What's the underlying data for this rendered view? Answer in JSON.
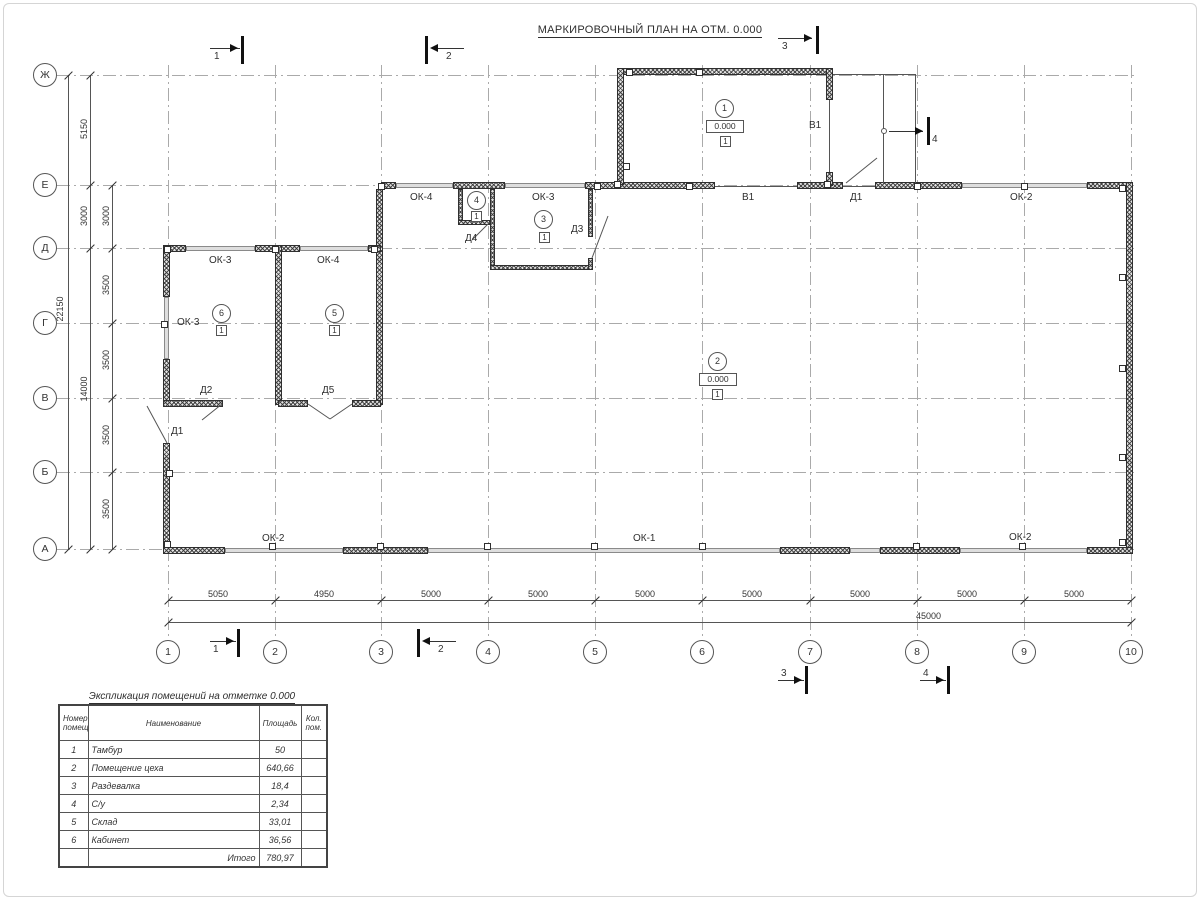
{
  "title": "МАРКИРОВОЧНЫЙ ПЛАН НА ОТМ. 0.000",
  "axis_rows": [
    "Ж",
    "Е",
    "Д",
    "Г",
    "В",
    "Б",
    "А"
  ],
  "axis_cols": [
    "1",
    "2",
    "3",
    "4",
    "5",
    "6",
    "7",
    "8",
    "9",
    "10"
  ],
  "dims": {
    "total_height": "22150",
    "total_width": "45000",
    "col_a": [
      "5150",
      "3000",
      "14000"
    ],
    "col_b": [
      "3000",
      "3500",
      "3500",
      "3500",
      "3500"
    ],
    "bottom": [
      "5050",
      "4950",
      "5000",
      "5000",
      "5000",
      "5000",
      "5000",
      "5000",
      "5000"
    ]
  },
  "sections": {
    "s1": "1",
    "s2": "2",
    "s3": "3",
    "s4": "4"
  },
  "labels": {
    "ok1": "ОК-1",
    "ok2": "ОК-2",
    "ok3": "ОК-3",
    "ok4": "ОК-4",
    "d1": "Д1",
    "d2": "Д2",
    "d3": "Д3",
    "d4": "Д4",
    "d5": "Д5",
    "v1": "В1"
  },
  "rooms": [
    {
      "num": "1",
      "elev": "0.000",
      "floor": "1"
    },
    {
      "num": "2",
      "elev": "0.000",
      "floor": "1"
    },
    {
      "num": "3",
      "floor": "1"
    },
    {
      "num": "4",
      "floor": "1"
    },
    {
      "num": "5",
      "floor": "1"
    },
    {
      "num": "6",
      "floor": "1"
    }
  ],
  "table": {
    "title": "Экспликация помещений на отметке 0.000",
    "headers": {
      "num": "Номер помещ.",
      "name": "Наименование",
      "area": "Площадь",
      "count": "Кол. пом."
    },
    "rows": [
      {
        "num": "1",
        "name": "Тамбур",
        "area": "50"
      },
      {
        "num": "2",
        "name": "Помещение цеха",
        "area": "640,66"
      },
      {
        "num": "3",
        "name": "Раздевалка",
        "area": "18,4"
      },
      {
        "num": "4",
        "name": "С/у",
        "area": "2,34"
      },
      {
        "num": "5",
        "name": "Склад",
        "area": "33,01"
      },
      {
        "num": "6",
        "name": "Кабинет",
        "area": "36,56"
      }
    ],
    "total_label": "Итого",
    "total_value": "780,97"
  }
}
